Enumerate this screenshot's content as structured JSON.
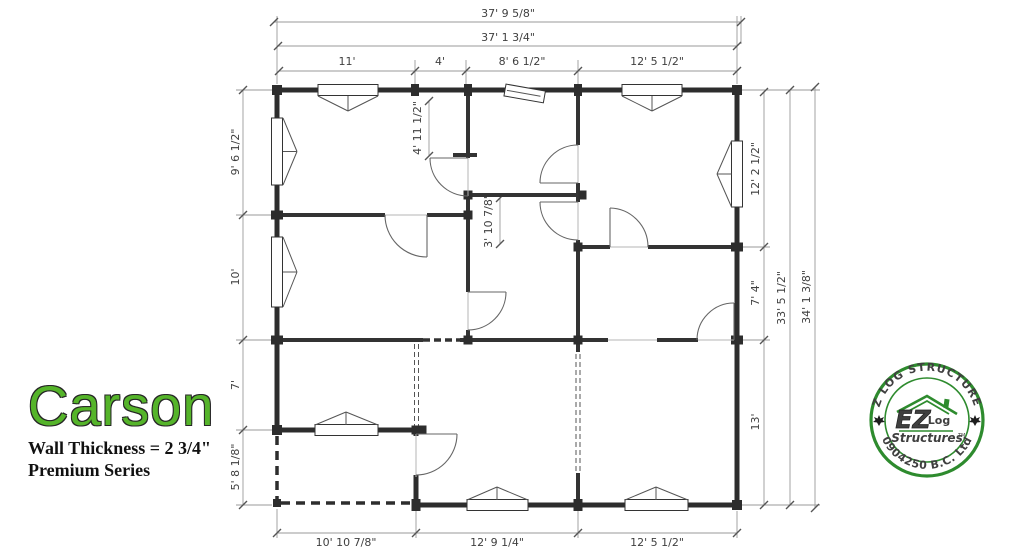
{
  "title": {
    "name": "Carson",
    "wall_thickness": "Wall Thickness = 2 3/4\"",
    "series": "Premium Series"
  },
  "dims": {
    "top_outer": "37' 9 5/8\"",
    "top_inner": "37' 1 3/4\"",
    "top_seg1": "11'",
    "top_seg2": "4'",
    "top_seg3": "8' 6 1/2\"",
    "top_seg4": "12' 5 1/2\"",
    "left_seg1": "9' 6 1/2\"",
    "left_seg2": "10'",
    "left_seg3": "7'",
    "left_seg4": "5' 8 1/8\"",
    "right_seg1": "12' 2 1/2\"",
    "right_seg2": "7' 4\"",
    "right_seg3": "13'",
    "right_inner": "33' 5 1/2\"",
    "right_outer": "34' 1 3/8\"",
    "bottom_seg1": "10' 10 7/8\"",
    "bottom_seg2": "12' 9 1/4\"",
    "bottom_seg3": "12' 5 1/2\"",
    "interior_v1": "4' 11 1/2\"",
    "interior_v2": "3' 10 7/8\""
  },
  "logo": {
    "arc_top": "EZ LOG STRUCTURES",
    "arc_bottom": "0904250 B.C. Ltd",
    "center_ez": "EZ",
    "center_log": "Log",
    "center_structures": "Structures",
    "tm": "TM",
    "green": "#2e8b2e"
  }
}
